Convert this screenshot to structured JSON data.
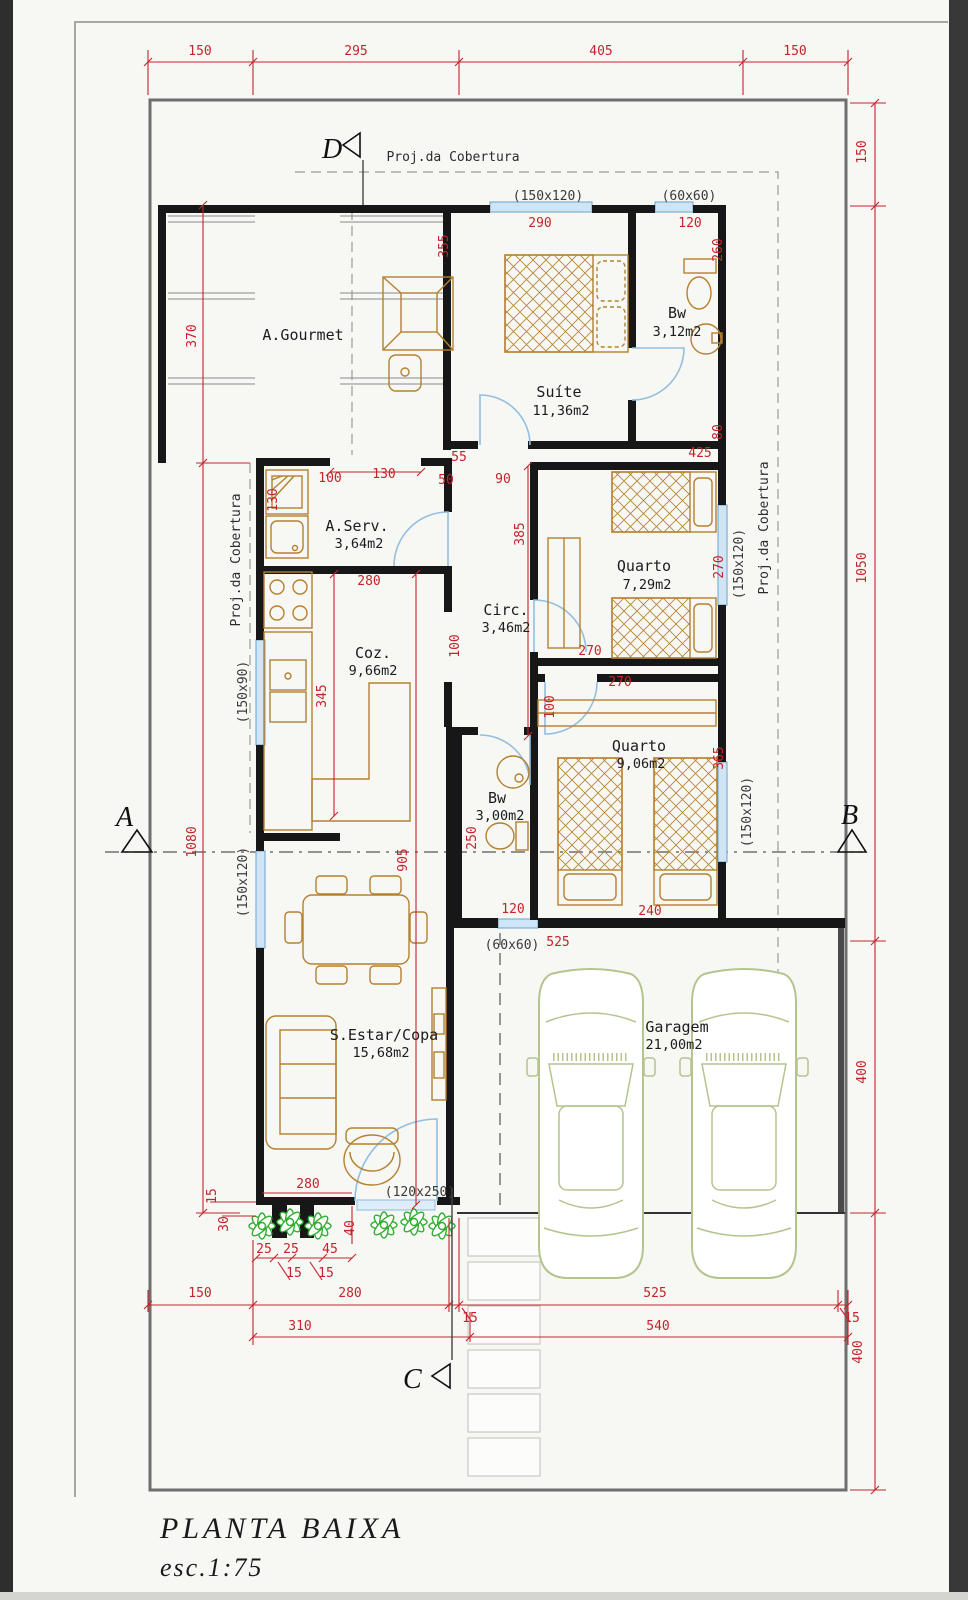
{
  "title_block": {
    "main": "PLANTA BAIXA",
    "scale": "esc.1:75"
  },
  "sections": {
    "a": "A",
    "b": "B",
    "c": "C",
    "d": "D"
  },
  "annotations": {
    "proj_top": "Proj.da Cobertura",
    "proj_left": "Proj.da Cobertura",
    "proj_right": "Proj.da Cobertura"
  },
  "rooms": [
    {
      "name": "A.Gourmet",
      "area": ""
    },
    {
      "name": "Suíte",
      "area": "11,36m2"
    },
    {
      "name": "Bw",
      "area": "3,12m2"
    },
    {
      "name": "A.Serv.",
      "area": "3,64m2"
    },
    {
      "name": "Quarto",
      "area": "7,29m2"
    },
    {
      "name": "Coz.",
      "area": "9,66m2"
    },
    {
      "name": "Circ.",
      "area": "3,46m2"
    },
    {
      "name": "Quarto",
      "area": "9,06m2"
    },
    {
      "name": "Bw",
      "area": "3,00m2"
    },
    {
      "name": "S.Estar/Copa",
      "area": "15,68m2"
    },
    {
      "name": "Garagem",
      "area": "21,00m2"
    }
  ],
  "colors": {
    "dimension_red": "#c4242b",
    "wall_black": "#171717",
    "furniture_brown": "#b5802f",
    "window_blue": "#cfe4f5",
    "car_green": "#b4c48e",
    "plant_green": "#2fae2f"
  },
  "plan": {
    "dim_labels": [
      {
        "t": "150",
        "x": 200,
        "y": 55,
        "c": "red"
      },
      {
        "t": "295",
        "x": 356,
        "y": 55,
        "c": "red"
      },
      {
        "t": "405",
        "x": 601,
        "y": 55,
        "c": "red"
      },
      {
        "t": "150",
        "x": 795,
        "y": 55,
        "c": "red"
      },
      {
        "t": "150",
        "x": 866,
        "y": 152,
        "r": -90,
        "c": "red"
      },
      {
        "t": "1050",
        "x": 866,
        "y": 568,
        "r": -90,
        "c": "red"
      },
      {
        "t": "400",
        "x": 866,
        "y": 1072,
        "r": -90,
        "c": "red"
      },
      {
        "t": "400",
        "x": 862,
        "y": 1352,
        "r": -90,
        "c": "red"
      },
      {
        "t": "15",
        "x": 852,
        "y": 1322,
        "c": "red",
        "s": 11
      },
      {
        "t": "370",
        "x": 196,
        "y": 336,
        "r": -90,
        "c": "red"
      },
      {
        "t": "1080",
        "x": 196,
        "y": 842,
        "r": -90,
        "c": "red"
      },
      {
        "t": "150",
        "x": 200,
        "y": 1297,
        "c": "red"
      },
      {
        "t": "280",
        "x": 350,
        "y": 1297,
        "c": "red"
      },
      {
        "t": "15",
        "x": 470,
        "y": 1322,
        "c": "red",
        "s": 11
      },
      {
        "t": "525",
        "x": 655,
        "y": 1297,
        "c": "red"
      },
      {
        "t": "310",
        "x": 300,
        "y": 1330,
        "c": "red"
      },
      {
        "t": "540",
        "x": 658,
        "y": 1330,
        "c": "red"
      },
      {
        "t": "(150x120)",
        "x": 548,
        "y": 200,
        "c": "blk",
        "s": 12
      },
      {
        "t": "290",
        "x": 540,
        "y": 227,
        "c": "red"
      },
      {
        "t": "(60x60)",
        "x": 689,
        "y": 200,
        "c": "blk",
        "s": 12
      },
      {
        "t": "120",
        "x": 690,
        "y": 227,
        "c": "red"
      },
      {
        "t": "260",
        "x": 722,
        "y": 250,
        "r": -90,
        "c": "red"
      },
      {
        "t": "355",
        "x": 448,
        "y": 246,
        "r": -90,
        "c": "red"
      },
      {
        "t": "55",
        "x": 459,
        "y": 461,
        "c": "red"
      },
      {
        "t": "50",
        "x": 446,
        "y": 484,
        "c": "red"
      },
      {
        "t": "90",
        "x": 503,
        "y": 483,
        "c": "red"
      },
      {
        "t": "425",
        "x": 700,
        "y": 457,
        "c": "red"
      },
      {
        "t": "80",
        "x": 722,
        "y": 432,
        "r": -90,
        "c": "red"
      },
      {
        "t": "100",
        "x": 330,
        "y": 482,
        "c": "red"
      },
      {
        "t": "130",
        "x": 384,
        "y": 478,
        "c": "red"
      },
      {
        "t": "130",
        "x": 277,
        "y": 500,
        "r": -90,
        "c": "red"
      },
      {
        "t": "280",
        "x": 369,
        "y": 585,
        "c": "red"
      },
      {
        "t": "385",
        "x": 524,
        "y": 534,
        "r": -90,
        "c": "red"
      },
      {
        "t": "100",
        "x": 459,
        "y": 646,
        "r": -90,
        "c": "red"
      },
      {
        "t": "270",
        "x": 590,
        "y": 655,
        "c": "red"
      },
      {
        "t": "270",
        "x": 723,
        "y": 567,
        "r": -90,
        "c": "red"
      },
      {
        "t": "(150x120)",
        "x": 743,
        "y": 564,
        "r": -90,
        "c": "blk",
        "s": 12
      },
      {
        "t": "270",
        "x": 620,
        "y": 686,
        "c": "red"
      },
      {
        "t": "100",
        "x": 554,
        "y": 707,
        "r": -90,
        "c": "red"
      },
      {
        "t": "365",
        "x": 723,
        "y": 758,
        "r": -90,
        "c": "red"
      },
      {
        "t": "(150x120)",
        "x": 751,
        "y": 812,
        "r": -90,
        "c": "blk",
        "s": 12
      },
      {
        "t": "250",
        "x": 476,
        "y": 838,
        "r": -90,
        "c": "red"
      },
      {
        "t": "905",
        "x": 407,
        "y": 860,
        "r": -90,
        "c": "red"
      },
      {
        "t": "345",
        "x": 326,
        "y": 696,
        "r": -90,
        "c": "red"
      },
      {
        "t": "240",
        "x": 650,
        "y": 915,
        "c": "red"
      },
      {
        "t": "120",
        "x": 513,
        "y": 913,
        "c": "red"
      },
      {
        "t": "(60x60)",
        "x": 512,
        "y": 949,
        "c": "blk",
        "s": 12
      },
      {
        "t": "525",
        "x": 558,
        "y": 946,
        "c": "red"
      },
      {
        "t": "(150x90)",
        "x": 247,
        "y": 692,
        "r": -90,
        "c": "blk",
        "s": 12
      },
      {
        "t": "(150x120)",
        "x": 247,
        "y": 882,
        "r": -90,
        "c": "blk",
        "s": 12
      },
      {
        "t": "(120x250)",
        "x": 420,
        "y": 1196,
        "c": "blk",
        "s": 12
      },
      {
        "t": "15",
        "x": 216,
        "y": 1196,
        "r": -90,
        "c": "red",
        "s": 11
      },
      {
        "t": "30",
        "x": 228,
        "y": 1224,
        "r": -90,
        "c": "red",
        "s": 11
      },
      {
        "t": "280",
        "x": 308,
        "y": 1188,
        "c": "red",
        "s": 12
      },
      {
        "t": "25",
        "x": 264,
        "y": 1253,
        "c": "red",
        "s": 11
      },
      {
        "t": "25",
        "x": 291,
        "y": 1253,
        "c": "red",
        "s": 11
      },
      {
        "t": "45",
        "x": 330,
        "y": 1253,
        "c": "red",
        "s": 11
      },
      {
        "t": "15",
        "x": 294,
        "y": 1277,
        "c": "red",
        "s": 11
      },
      {
        "t": "15",
        "x": 326,
        "y": 1277,
        "c": "red",
        "s": 11
      },
      {
        "t": "40",
        "x": 354,
        "y": 1228,
        "r": -90,
        "c": "red",
        "s": 11
      }
    ]
  }
}
